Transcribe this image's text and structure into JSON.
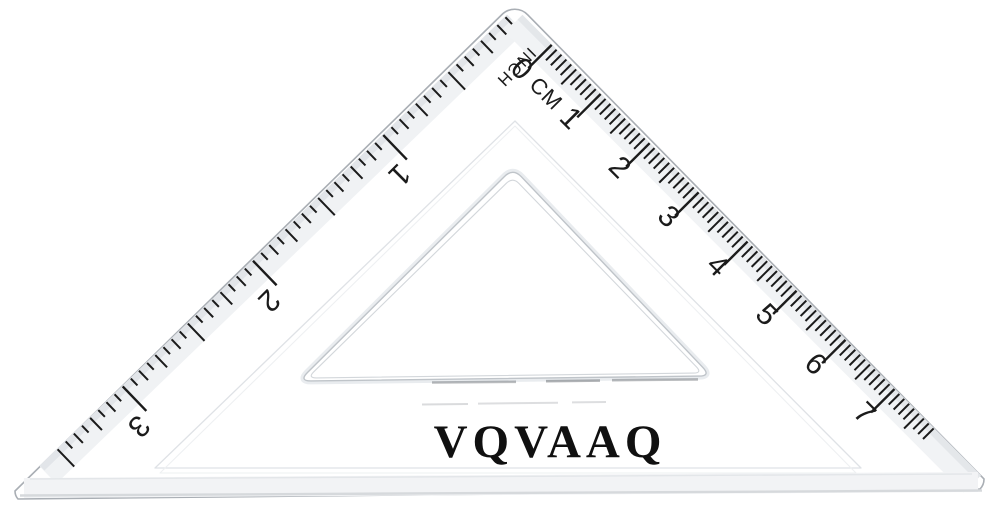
{
  "product": {
    "brand": "VQVAAQ"
  },
  "set_square": {
    "description": "transparent 45-degree set square ruler",
    "cm_scale": {
      "unit_label": "CM",
      "start_label": "0",
      "numbers": [
        "1",
        "2",
        "3",
        "4",
        "5",
        "6",
        "7"
      ],
      "minor_ticks_per_cm": 10,
      "total_minor_ticks": 78
    },
    "inch_scale": {
      "unit_label": "INCH",
      "numbers": [
        "1",
        "2",
        "3"
      ],
      "divisions_per_inch": 16,
      "total_ticks": 56
    },
    "colors": {
      "tick_ink": "#1b1b1b",
      "edge_outline": "#a9aeb4",
      "bevel_light": "#f1f3f5",
      "bevel_mid": "#d6d9dc",
      "cutout_line": "#bfc4c9",
      "brand_ink": "#101010"
    }
  }
}
